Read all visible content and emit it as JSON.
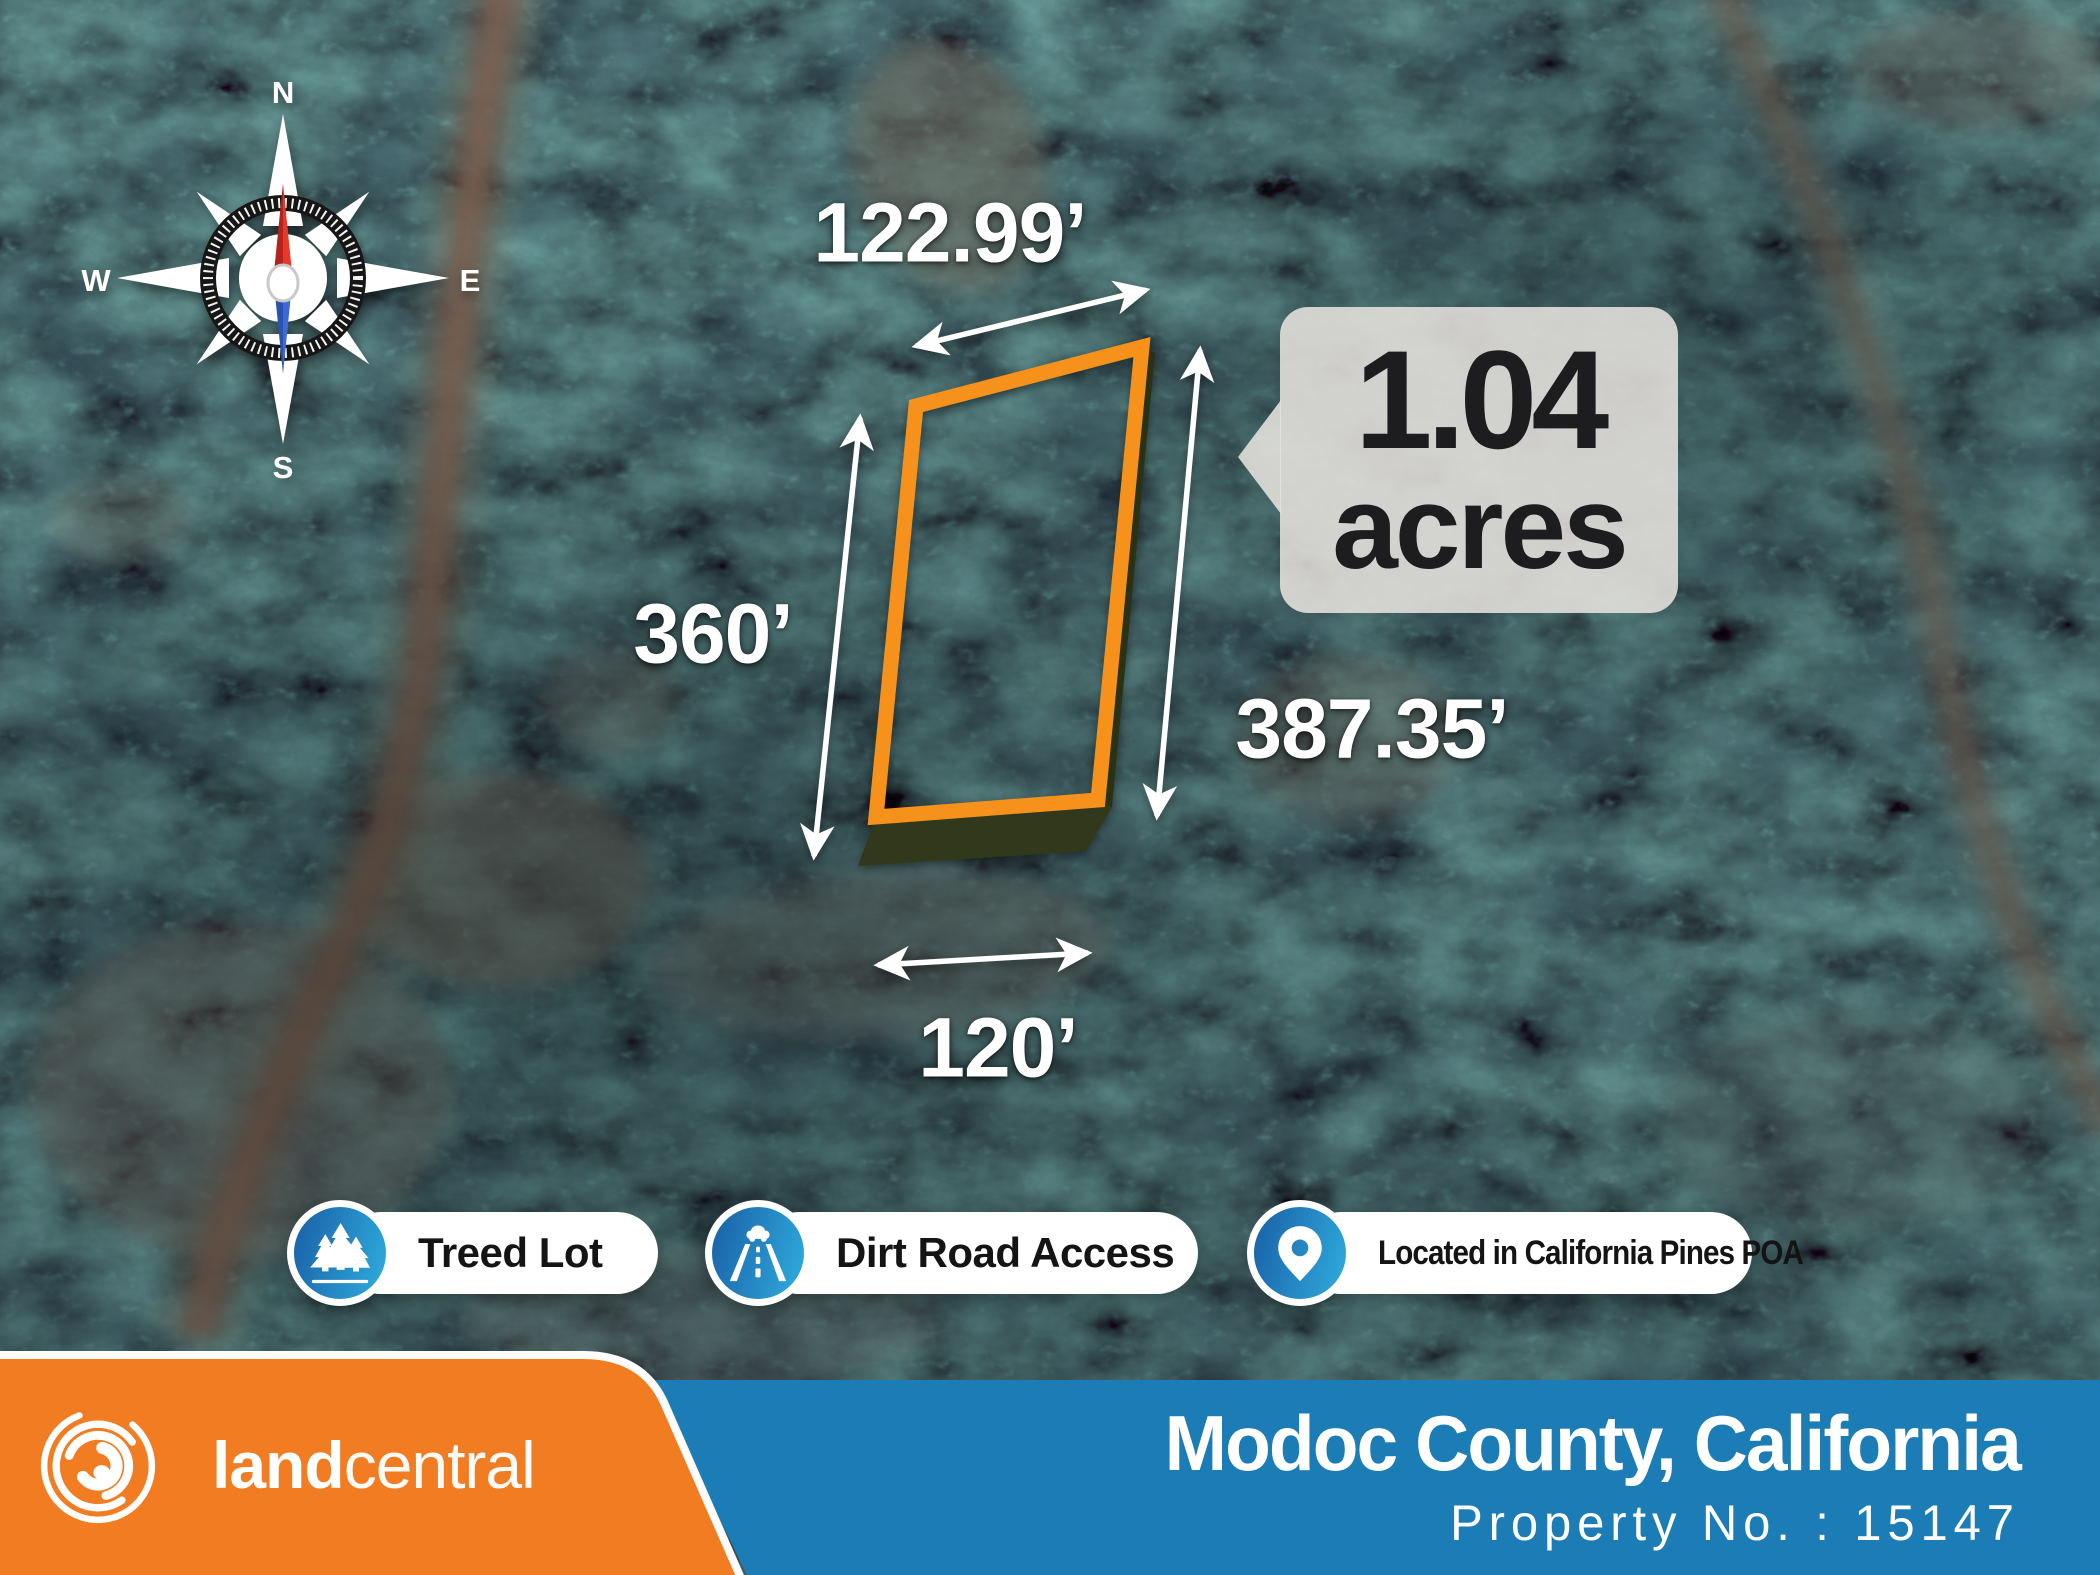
{
  "compass": {
    "n": "N",
    "e": "E",
    "s": "S",
    "w": "W"
  },
  "dimensions": {
    "top": "122.99’",
    "left": "360’",
    "right": "387.35’",
    "bottom": "120’"
  },
  "area_callout": {
    "value": "1.04",
    "unit": "acres"
  },
  "features": [
    {
      "icon": "pine-trees-icon",
      "label": "Treed Lot"
    },
    {
      "icon": "road-icon",
      "label": "Dirt Road Access"
    },
    {
      "icon": "location-pin-icon",
      "label": "Located in California Pines POA"
    }
  ],
  "footer": {
    "brand_bold": "land",
    "brand_light": "central",
    "location": "Modoc County, California",
    "property_no": "Property No. : 15147"
  },
  "colors": {
    "parcel_outline": "#F6921E",
    "footer_orange": "#F17C21",
    "footer_blue": "#1C7CB5",
    "badge_blue_dark": "#1A63A9",
    "badge_blue_light": "#2FA9DC",
    "callout_text": "#1D1D20"
  }
}
